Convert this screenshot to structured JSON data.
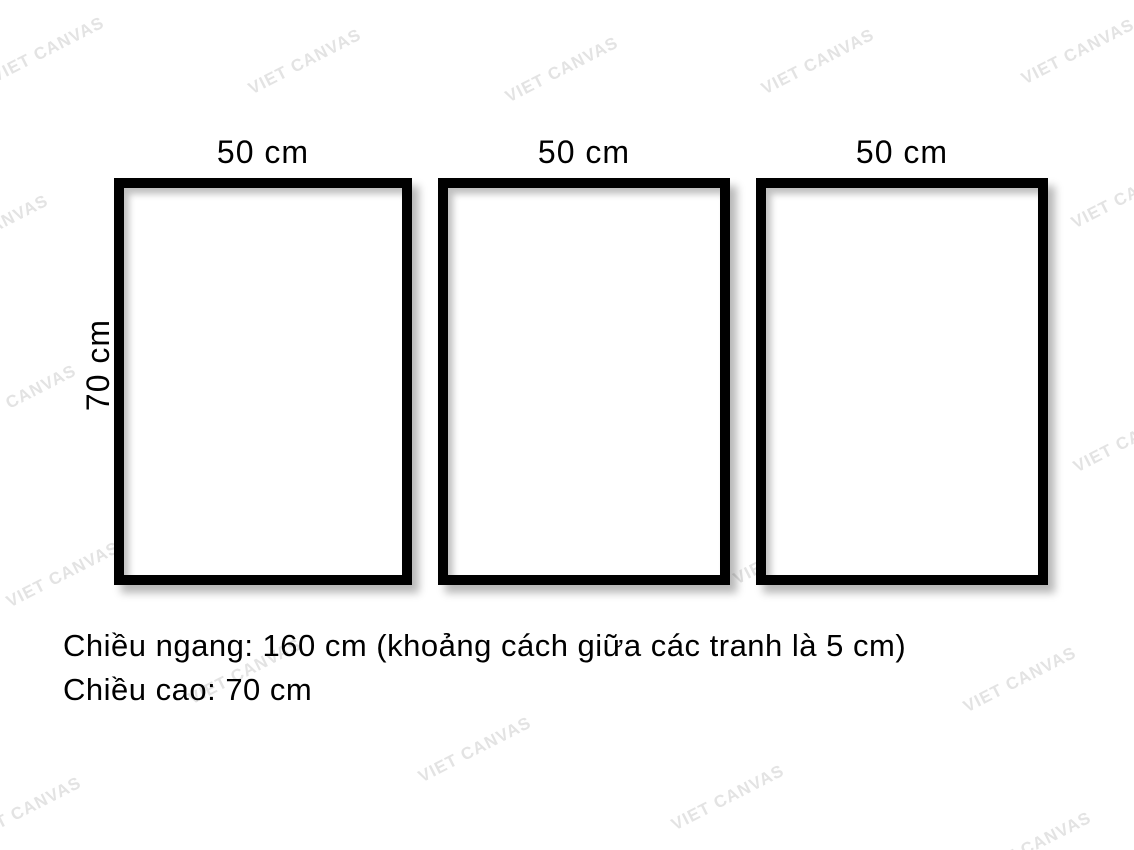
{
  "background": "#ffffff",
  "frame_color": "#000000",
  "watermark": {
    "text": "VIET CANVAS",
    "color": "#e3e3e3",
    "positions": [
      {
        "x": 48,
        "y": 50
      },
      {
        "x": 305,
        "y": 62
      },
      {
        "x": 562,
        "y": 70
      },
      {
        "x": 818,
        "y": 62
      },
      {
        "x": 1078,
        "y": 52
      },
      {
        "x": -8,
        "y": 228
      },
      {
        "x": 277,
        "y": 250
      },
      {
        "x": 560,
        "y": 258
      },
      {
        "x": 832,
        "y": 330
      },
      {
        "x": 1128,
        "y": 196
      },
      {
        "x": 20,
        "y": 398
      },
      {
        "x": 330,
        "y": 410
      },
      {
        "x": 1130,
        "y": 440
      },
      {
        "x": 522,
        "y": 514
      },
      {
        "x": 790,
        "y": 552
      },
      {
        "x": 63,
        "y": 575
      },
      {
        "x": 245,
        "y": 672
      },
      {
        "x": 1020,
        "y": 680
      },
      {
        "x": 475,
        "y": 750
      },
      {
        "x": 728,
        "y": 798
      },
      {
        "x": 25,
        "y": 810
      },
      {
        "x": 1035,
        "y": 845
      }
    ]
  },
  "frames": [
    {
      "width_label": "50 cm"
    },
    {
      "width_label": "50 cm"
    },
    {
      "width_label": "50 cm"
    }
  ],
  "height_label": "70 cm",
  "caption": {
    "line1": "Chiều ngang: 160 cm (khoảng cách giữa các tranh là 5 cm)",
    "line2": "Chiều cao: 70 cm"
  }
}
